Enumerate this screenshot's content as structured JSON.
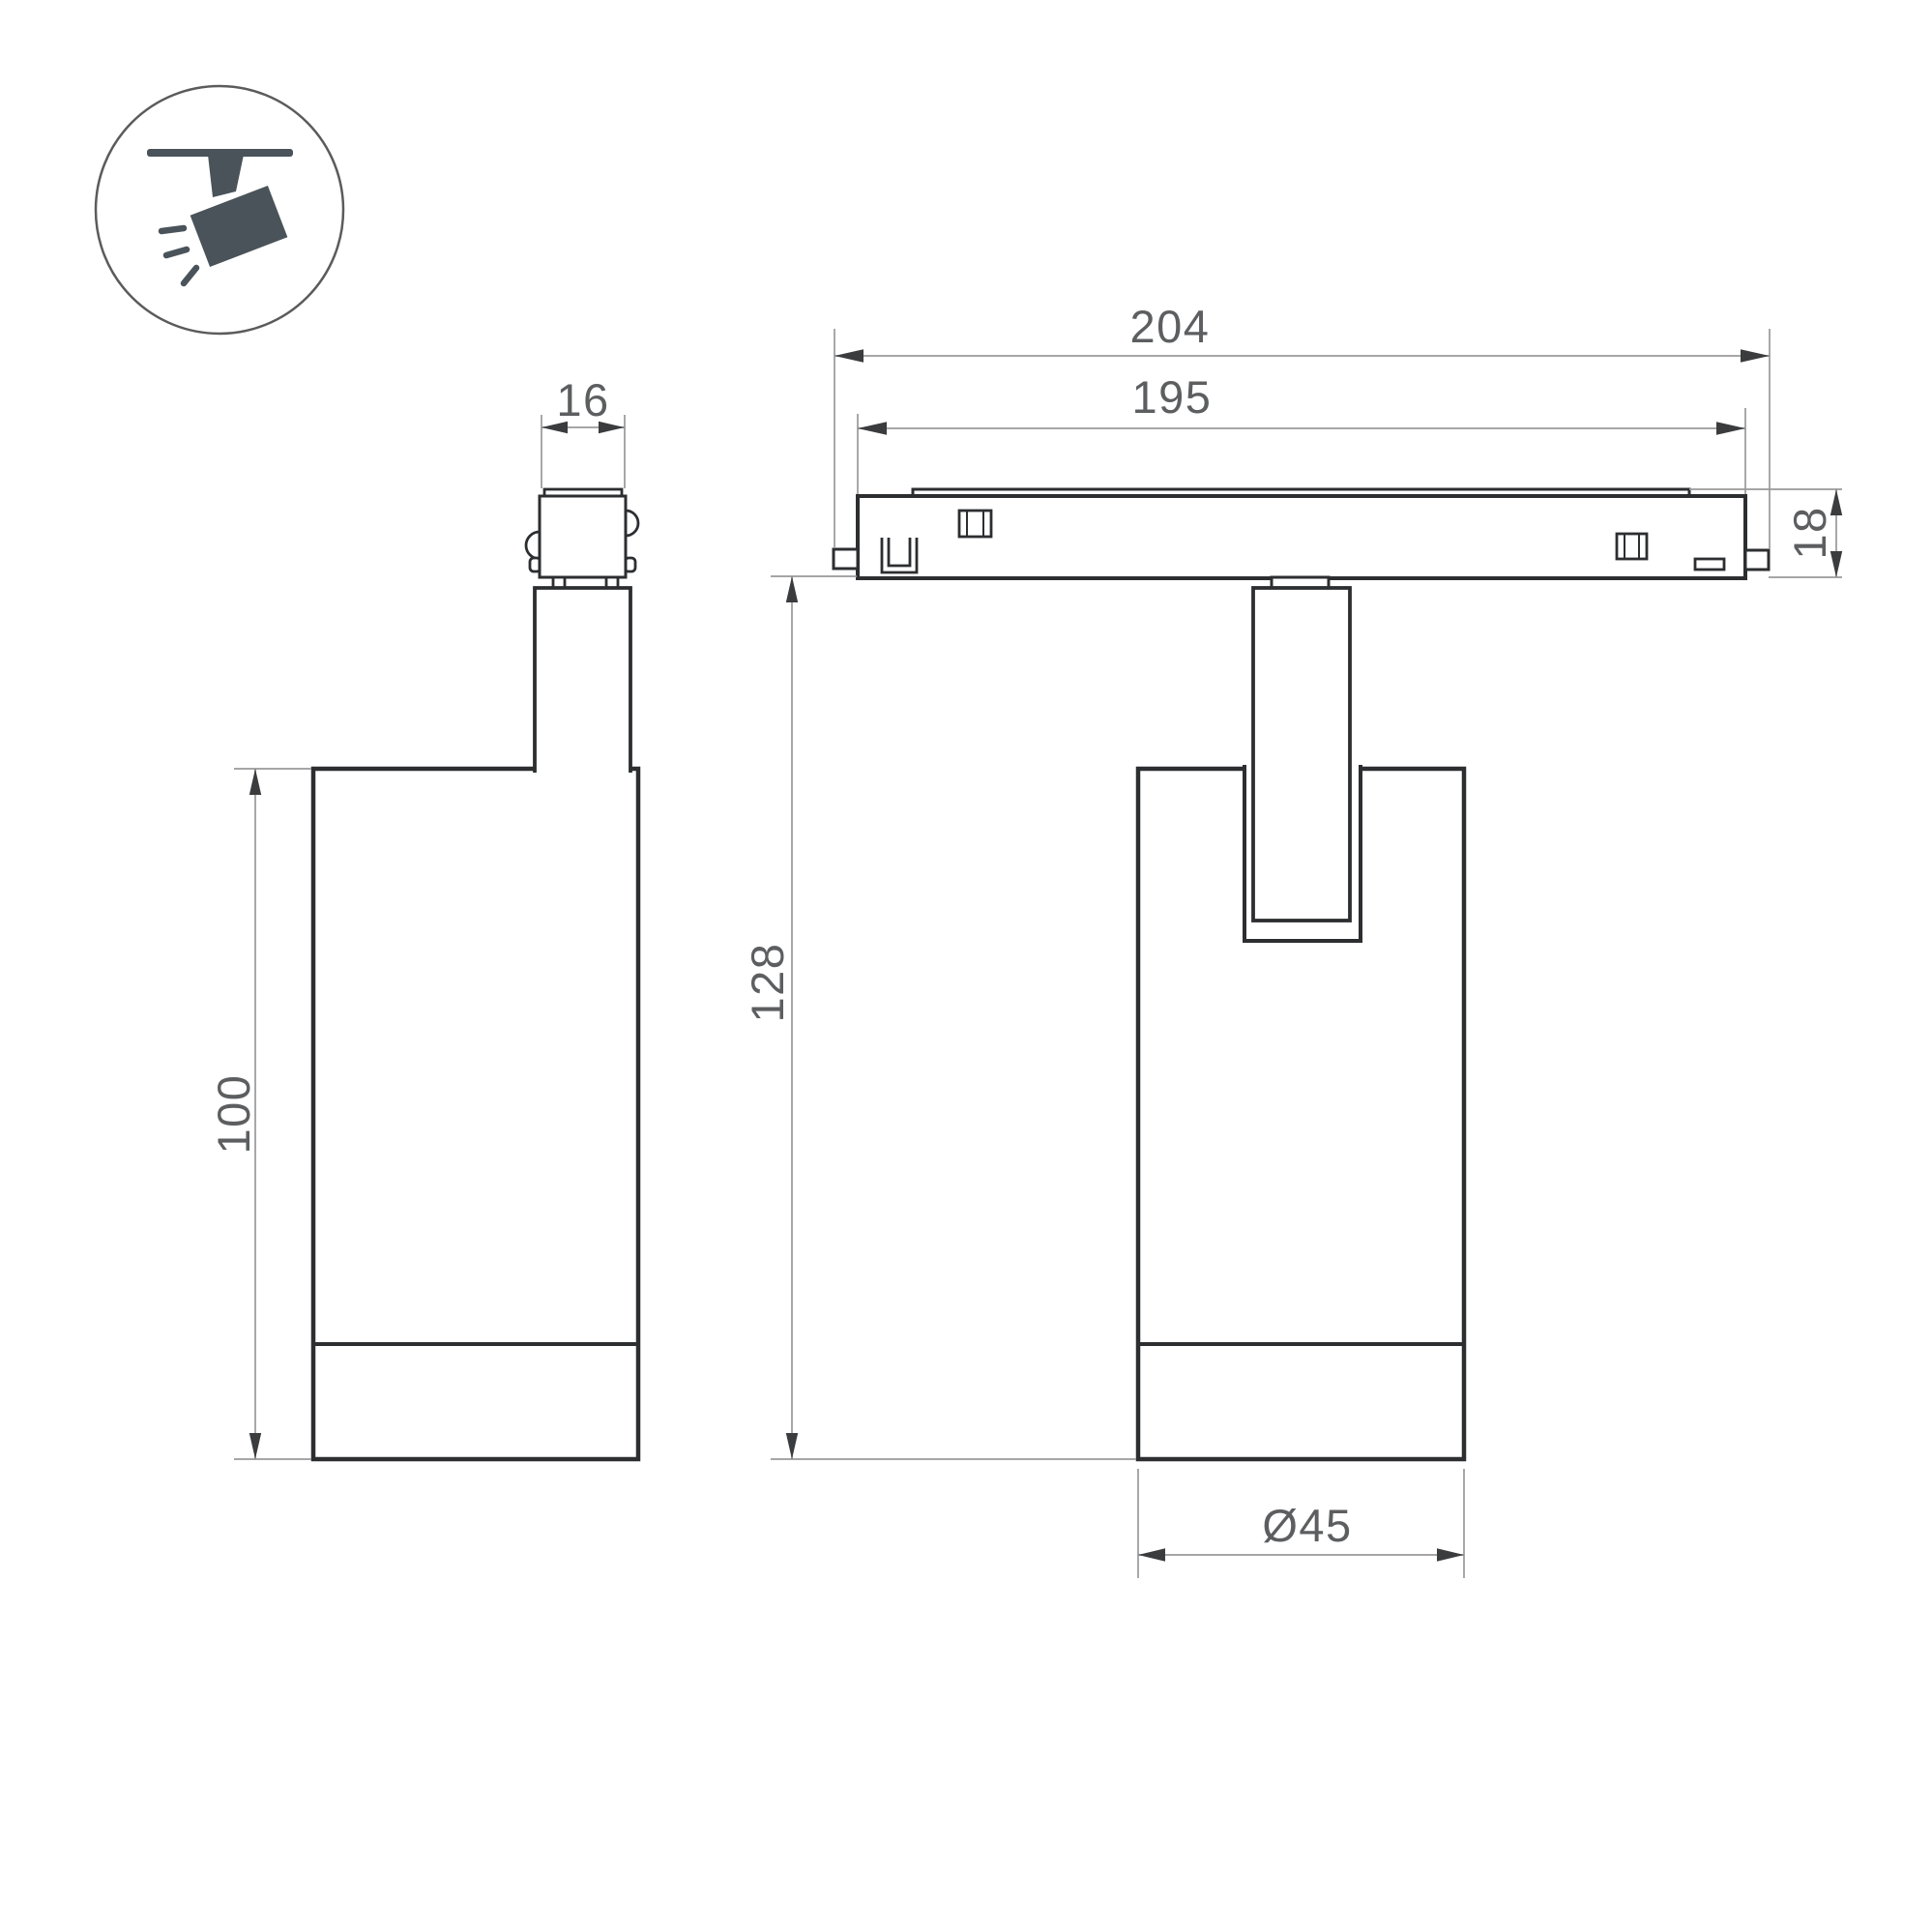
{
  "colors": {
    "outline": "#2c2e30",
    "thin_line": "#999999",
    "arrow": "#3a3c3e",
    "text": "#5c5e60",
    "icon_fill": "#4a535a",
    "ring": "#5b5b5b",
    "background": "#ffffff"
  },
  "icon_badge": {
    "name": "ceiling-track-spotlight",
    "fill": "#4a535a"
  },
  "front_view": {
    "dim_connector_width": "16",
    "dim_body_height": "100"
  },
  "side_view": {
    "dim_overall_length": "204",
    "dim_track_length": "195",
    "dim_track_height": "18",
    "dim_overall_height": "128",
    "dim_body_diameter": "Ø45"
  }
}
